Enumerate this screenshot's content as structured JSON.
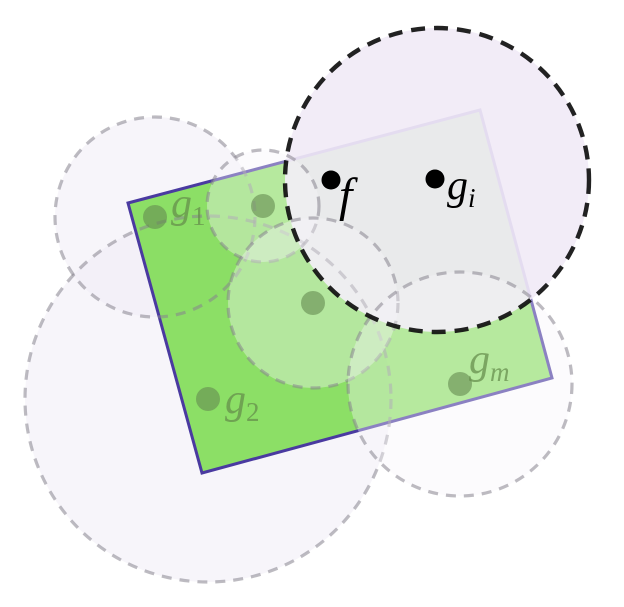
{
  "scene": {
    "width": 624,
    "height": 607,
    "background": "#ffffff",
    "styles": {
      "gray_circle_stroke": "rgba(134,131,142,0.55)",
      "gray_circle_stroke_width": 3.2,
      "gray_circle_dash": "10 8",
      "pale_fill_under": "rgba(240,235,246,0.5)",
      "pale_fill_over": "rgba(247,244,250,0.38)",
      "rect_fill": "rgba(98,215,45,0.72)",
      "rect_stroke": "#4a3aa0",
      "rect_stroke_width": 3,
      "ball_fill": "rgba(241,234,246,0.92)",
      "ball_stroke": "rgba(15,15,15,0.92)",
      "ball_stroke_width": 4.4,
      "ball_dash": "14 9",
      "green_dot_fill": "rgba(100,138,80,0.6)",
      "green_label_fill": "rgba(100,140,75,0.72)",
      "black_label_fill": "#000000",
      "black_dot_fill": "#000000"
    },
    "under_circles": [
      {
        "name": "dashed-ball-around-g1",
        "cx": 155,
        "cy": 217,
        "r": 100
      },
      {
        "name": "dashed-ball-around-g2",
        "cx": 208,
        "cy": 399,
        "r": 183
      }
    ],
    "rectangle": {
      "name": "green-rectangle",
      "points": "128,203 480,110 552,378 202,473"
    },
    "black_ball": {
      "name": "black-dashed-ball-around-gi",
      "cx": 437,
      "cy": 180,
      "r": 152
    },
    "over_circles": [
      {
        "name": "dashed-ball-around-top-dot",
        "cx": 263,
        "cy": 206,
        "r": 56
      },
      {
        "name": "dashed-ball-around-center-dot",
        "cx": 313,
        "cy": 303,
        "r": 85
      },
      {
        "name": "dashed-ball-around-gm",
        "cx": 460,
        "cy": 384,
        "r": 112
      }
    ],
    "green_points": [
      {
        "name": "dot-g1",
        "x": 155,
        "y": 217,
        "r": 12
      },
      {
        "name": "dot-unlabeled-top",
        "x": 263,
        "y": 206,
        "r": 12
      },
      {
        "name": "dot-unlabeled-center",
        "x": 313,
        "y": 303,
        "r": 12
      },
      {
        "name": "dot-g2",
        "x": 208,
        "y": 399,
        "r": 12
      },
      {
        "name": "dot-gm",
        "x": 460,
        "y": 384,
        "r": 12
      }
    ],
    "black_points": [
      {
        "name": "point-f",
        "x": 331,
        "y": 180,
        "r": 9.5
      },
      {
        "name": "point-gi",
        "x": 435,
        "y": 179,
        "r": 9.5
      }
    ],
    "labels": [
      {
        "name": "label-f",
        "text": "f",
        "sub": "",
        "x": 339,
        "y": 211,
        "size": 48,
        "sub_size": 27,
        "sub_dy": 8,
        "sub_italic": true,
        "color": "black"
      },
      {
        "name": "label-gi",
        "text": "g",
        "sub": "i",
        "x": 447,
        "y": 199,
        "size": 42,
        "sub_size": 27,
        "sub_dy": 8,
        "sub_italic": true,
        "color": "black"
      },
      {
        "name": "label-g1",
        "text": "g",
        "sub": "1",
        "x": 171,
        "y": 217,
        "size": 42,
        "sub_size": 27,
        "sub_dy": 8,
        "sub_italic": false,
        "color": "green"
      },
      {
        "name": "label-g2",
        "text": "g",
        "sub": "2",
        "x": 225,
        "y": 413,
        "size": 42,
        "sub_size": 27,
        "sub_dy": 8,
        "sub_italic": false,
        "color": "green"
      },
      {
        "name": "label-gm",
        "text": "g",
        "sub": "m",
        "x": 469,
        "y": 373,
        "size": 42,
        "sub_size": 27,
        "sub_dy": 8,
        "sub_italic": true,
        "color": "green"
      }
    ]
  }
}
